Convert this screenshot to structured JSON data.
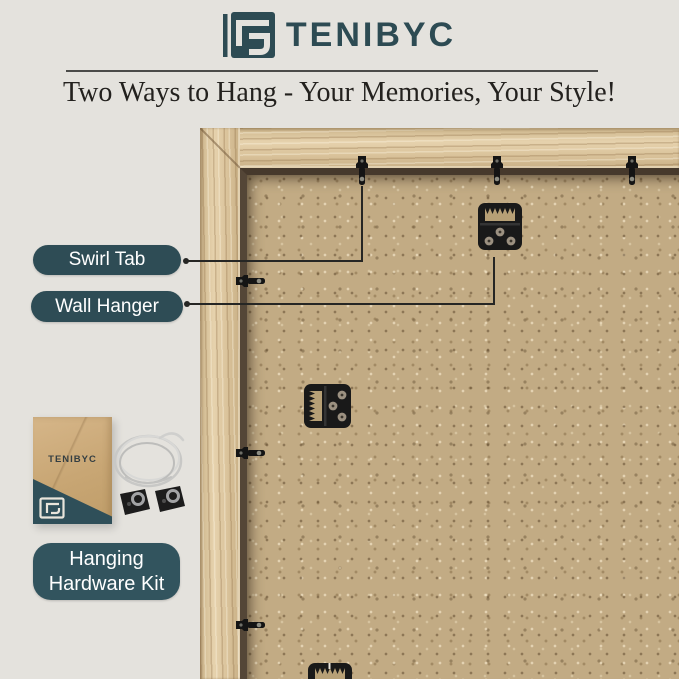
{
  "brand": {
    "name": "TENIBYC"
  },
  "header": {
    "tagline": "Two Ways to Hang - Your Memories, Your Style!"
  },
  "callouts": {
    "swirl_tab": {
      "label": "Swirl Tab"
    },
    "wall_hanger": {
      "label": "Wall Hanger"
    }
  },
  "kit": {
    "envelope_brand": "TENIBYC",
    "label_line1": "Hanging",
    "label_line2": "Hardware Kit"
  },
  "colors": {
    "accent_teal": "#2e4c55",
    "page_background": "#e4e2dd",
    "wood_frame": "#dcc49c",
    "backing_board": "#c2ab84",
    "hardware_black": "#191919",
    "title_text": "#23211e",
    "callout_text": "#ffffff"
  }
}
